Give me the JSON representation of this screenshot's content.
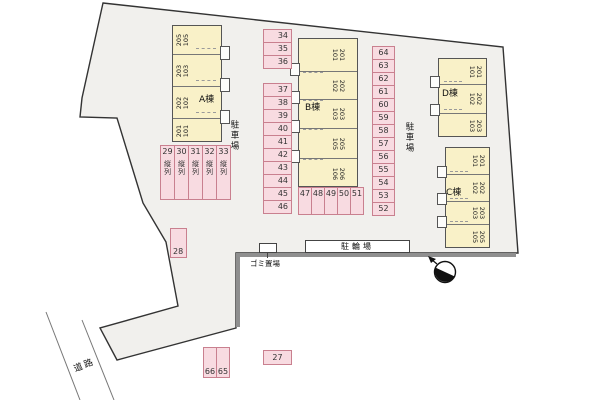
{
  "strings": {
    "road": "道路",
    "parking_lot": "駐車場",
    "bicycle_lot": "駐輪場",
    "garbage": "ゴミ置場",
    "tandem": "縦列"
  },
  "buildings": [
    {
      "name": "A棟",
      "units": [
        [
          "205",
          "105"
        ],
        [
          "203",
          "103"
        ],
        [
          "202",
          "102"
        ],
        [
          "201",
          "101"
        ]
      ]
    },
    {
      "name": "B棟",
      "units": [
        [
          "201",
          "101"
        ],
        [
          "202",
          "102"
        ],
        [
          "203",
          "103"
        ],
        [
          "205",
          "105"
        ],
        [
          "206",
          "106"
        ]
      ]
    },
    {
      "name": "C棟",
      "units": [
        [
          "201",
          "101"
        ],
        [
          "202",
          "102"
        ],
        [
          "203",
          "103"
        ],
        [
          "205",
          "105"
        ]
      ]
    },
    {
      "name": "D棟",
      "units": [
        [
          "201",
          "101"
        ],
        [
          "202",
          "102"
        ],
        [
          "203",
          "103"
        ]
      ]
    }
  ],
  "parking": {
    "tandem": [
      "29",
      "30",
      "31",
      "32",
      "33"
    ],
    "col_a_top": [
      "34",
      "35",
      "36"
    ],
    "col_a": [
      "37",
      "38",
      "39",
      "40",
      "41",
      "42",
      "43",
      "44",
      "45",
      "46"
    ],
    "row_b": [
      "47",
      "48",
      "49",
      "50",
      "51"
    ],
    "col_e": [
      "64",
      "63",
      "62",
      "61",
      "60",
      "59",
      "58",
      "57",
      "56",
      "55",
      "54",
      "53",
      "52"
    ],
    "spot_28": "28",
    "spot_27": "27",
    "pair_bottom": [
      "66",
      "65"
    ]
  },
  "colors": {
    "site_fill": "#f1f0ed",
    "building_fill": "#f9f1c8",
    "parking_fill": "#f8dbe1",
    "parking_border": "#c9808f",
    "wall": "#8f8f8f"
  }
}
